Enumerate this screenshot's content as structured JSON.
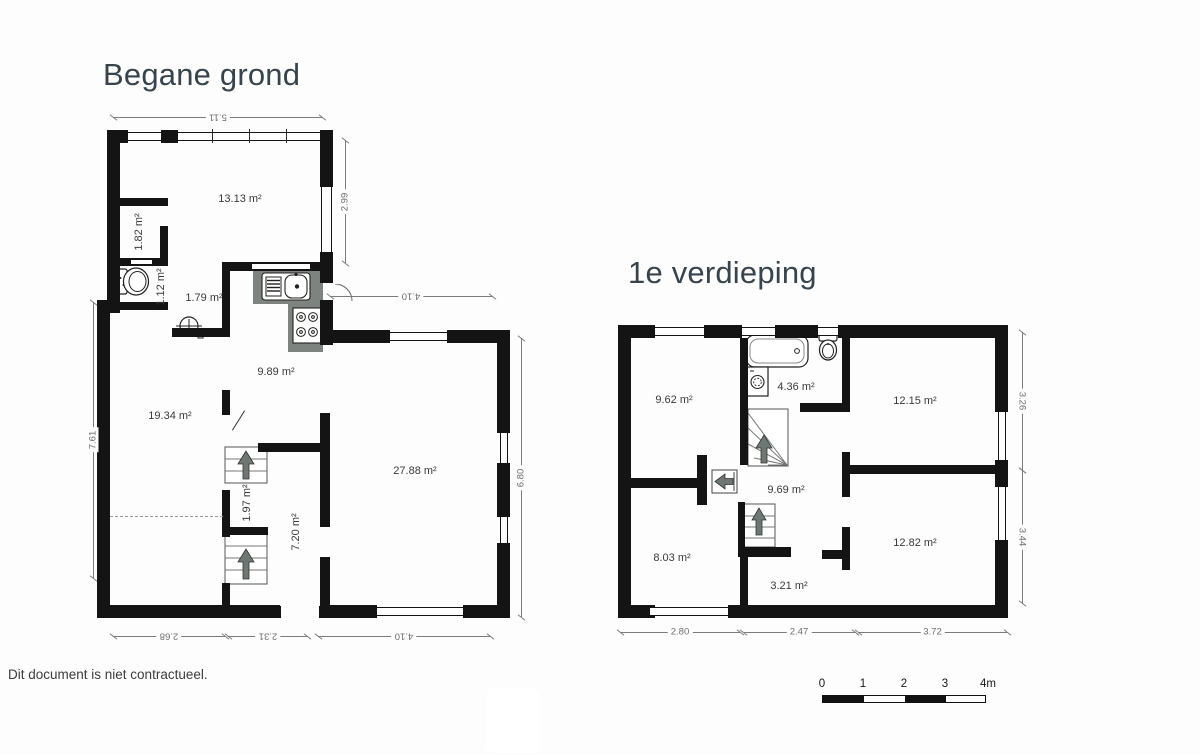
{
  "page": {
    "disclaimer": "Dit document is niet contractueel."
  },
  "ground_floor": {
    "title": "Begane grond",
    "rooms": {
      "living_front": "13.13 m²",
      "closet": "1.82 m²",
      "wc": "1.12 m²",
      "hall": "1.79 m²",
      "kitchen": "9.89 m²",
      "living_left": "19.34 m²",
      "living_right": "27.88 m²",
      "stair_closet": "1.97 m²",
      "passage": "7.20 m²"
    },
    "dimensions": {
      "top": "5.11",
      "right_upper": "2.99",
      "inner_top": "4.10",
      "right_lower": "6.80",
      "left": "7.61",
      "bottom_left": "2.68",
      "bottom_middle": "2.31",
      "bottom_right": "4.10"
    }
  },
  "first_floor": {
    "title": "1e verdieping",
    "rooms": {
      "bedroom_front_left": "9.62 m²",
      "bathroom": "4.36 m²",
      "bedroom_front_right": "12.15 m²",
      "landing": "9.69 m²",
      "bedroom_back_left": "8.03 m²",
      "storage": "3.21 m²",
      "bedroom_back_right": "12.82 m²"
    },
    "dimensions": {
      "right_upper": "3.26",
      "right_lower": "3.44",
      "bottom_left": "2.80",
      "bottom_middle": "2.47",
      "bottom_right": "3.72"
    }
  },
  "scale_bar": {
    "labels": [
      "0",
      "1",
      "2",
      "3",
      "4m"
    ]
  },
  "colors": {
    "wall": "#141414",
    "title": "#37444d",
    "kitchen_gray": "#7d837f",
    "stair_arrow": "#6f7773",
    "dimension": "#7c7c7c"
  }
}
